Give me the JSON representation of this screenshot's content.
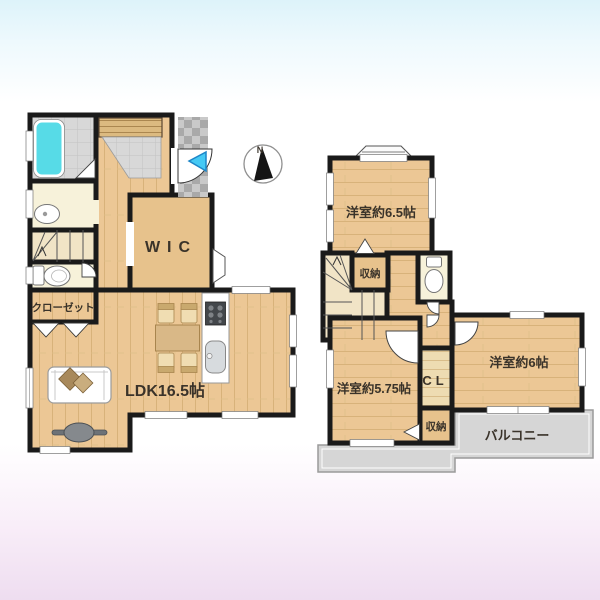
{
  "document": {
    "type": "floor-plan",
    "floors": [
      "1F",
      "2F"
    ]
  },
  "floor1": {
    "labels": {
      "wic": "WIC",
      "closet": "クローゼット",
      "ldk": "LDK16.5帖"
    }
  },
  "floor2": {
    "labels": {
      "room_65": "洋室約6.5帖",
      "storage_upper": "収納",
      "room_575": "洋室約5.75帖",
      "cl": "CL",
      "room_6": "洋室約6帖",
      "storage_lower": "収納",
      "balcony": "バルコニー"
    }
  },
  "compass": {
    "north_label": "N"
  },
  "icons": {
    "compass": "compass-north-indicator",
    "entrance_arrow": "entrance-direction-arrow"
  },
  "colors": {
    "wall": "#1a1a1a",
    "wood_floor": "#ecc795",
    "bathtub": "#57dbe7",
    "entrance_arrow": "#45c9f4",
    "balcony": "#d6d6d6",
    "cream_room": "#f7f2da"
  }
}
